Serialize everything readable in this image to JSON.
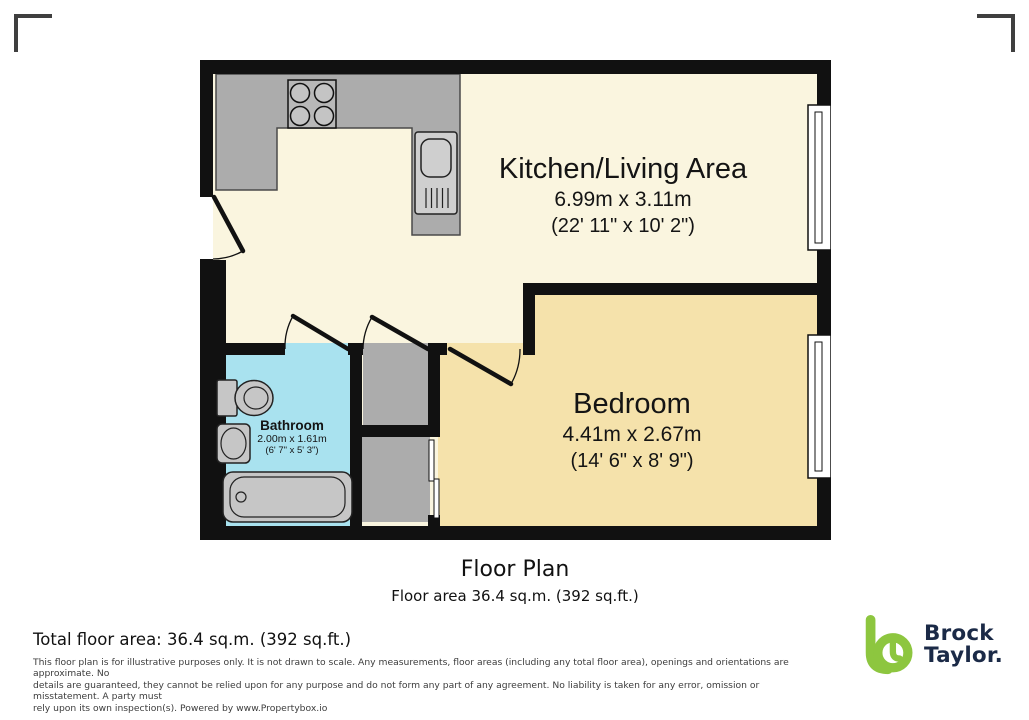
{
  "plan": {
    "rooms": [
      {
        "id": "kitchen_living",
        "name": "Kitchen/Living Area",
        "dimensions_m": "6.99m x 3.11m",
        "dimensions_ft": "(22' 11\" x 10' 2\")"
      },
      {
        "id": "bedroom",
        "name": "Bedroom",
        "dimensions_m": "4.41m x 2.67m",
        "dimensions_ft": "(14' 6\" x 8' 9\")"
      },
      {
        "id": "bathroom",
        "name": "Bathroom",
        "dimensions_m": "2.00m x 1.61m",
        "dimensions_ft": "(6' 7\" x 5' 3\")"
      }
    ],
    "icons": [
      "stove-icon",
      "sink-unit-icon",
      "toilet-icon",
      "basin-icon",
      "bathtub-icon",
      "window-icon",
      "door-swing-icon",
      "sliding-door-icon"
    ]
  },
  "caption": {
    "title": "Floor Plan",
    "subtitle": "Floor area 36.4 sq.m. (392 sq.ft.)"
  },
  "footer": {
    "total_area": "Total floor area: 36.4 sq.m. (392 sq.ft.)",
    "disclaimer_lines": [
      "This floor plan is for illustrative purposes only. It is not drawn to scale. Any measurements, floor areas (including any total floor area), openings and orientations are approximate. No",
      "details are guaranteed, they cannot be relied upon for any purpose and do not form any part of any agreement. No liability is taken for any error, omission or misstatement. A party must",
      "rely upon its own inspection(s). Powered by www.Propertybox.io"
    ]
  },
  "logo": {
    "line1": "Brock",
    "line2": "Taylor."
  },
  "colors": {
    "wall": "#111111",
    "kitchen_floor": "#FAF5DF",
    "bedroom_floor": "#F5E2AB",
    "bathroom_floor": "#A9E2EF",
    "counter": "#ACACAC",
    "fixture": "#C6C6C6",
    "logo_green": "#8DC63F",
    "logo_navy": "#1B2A47"
  }
}
